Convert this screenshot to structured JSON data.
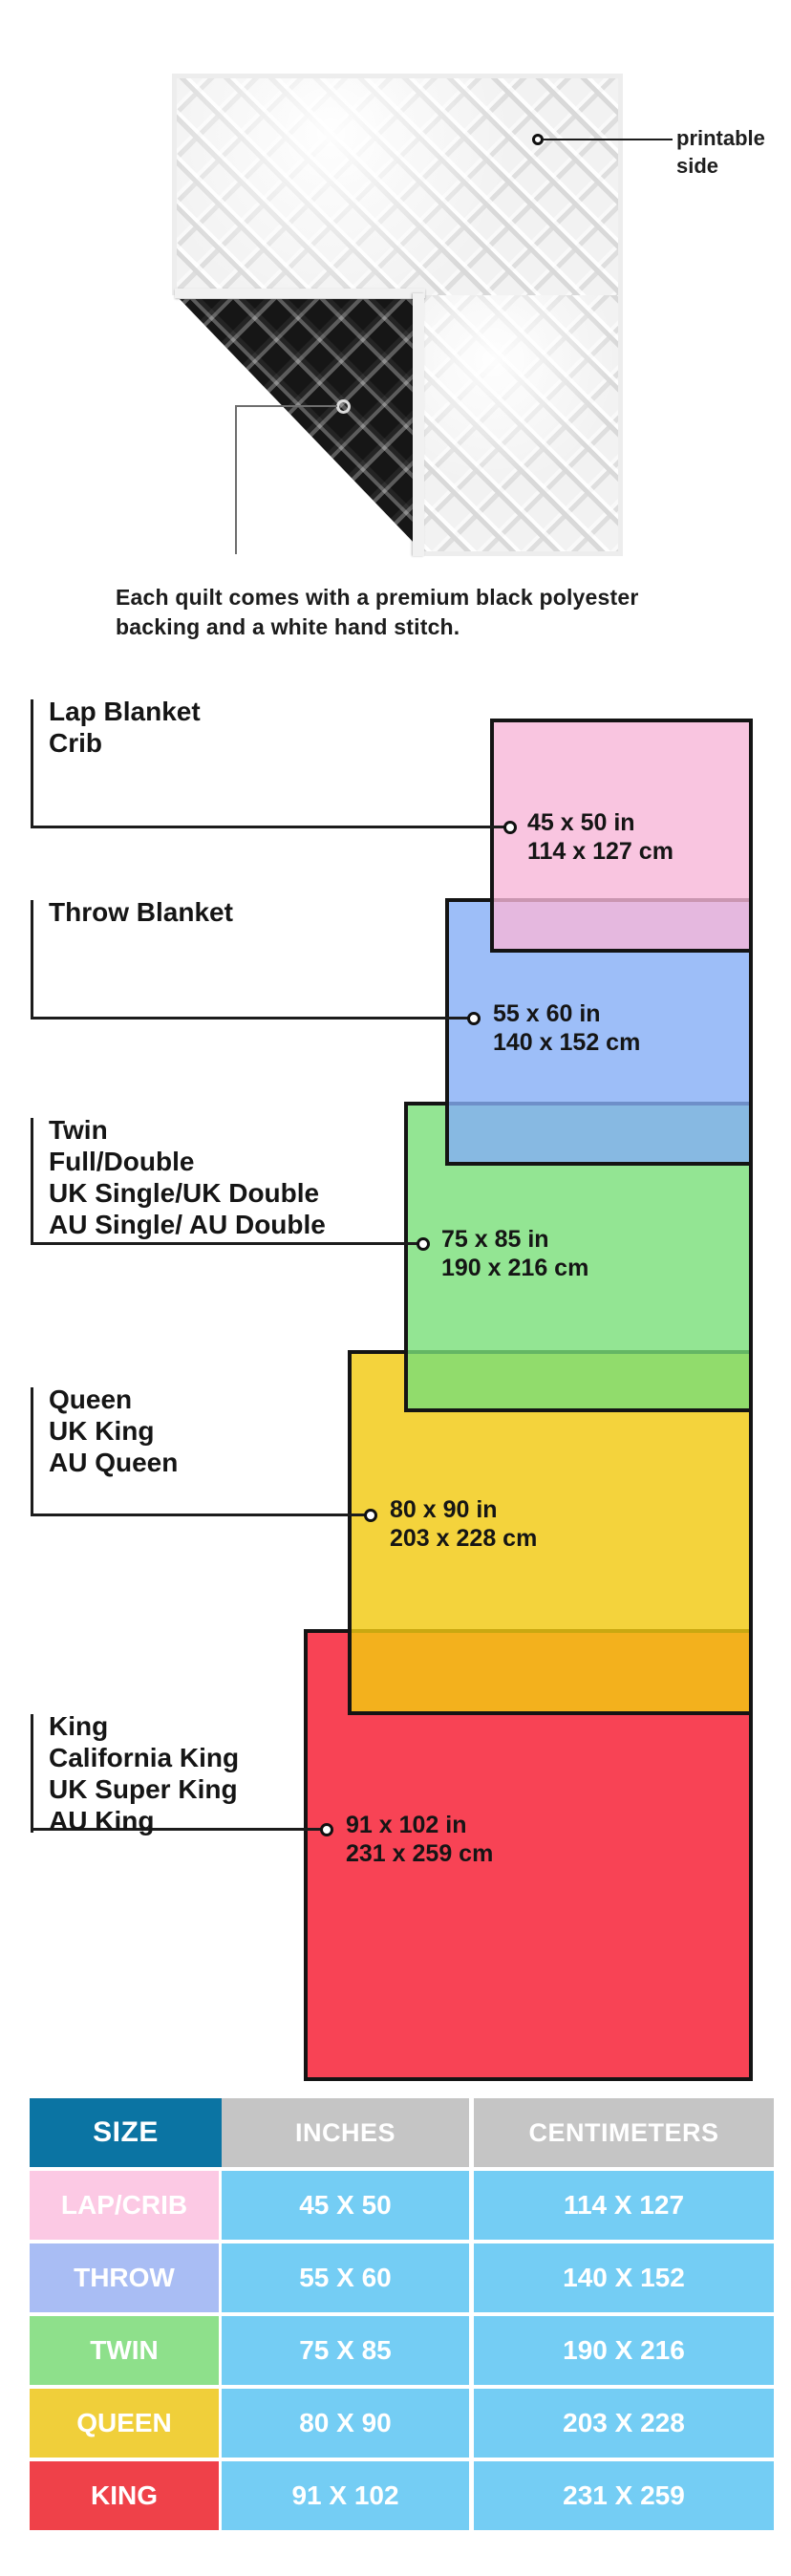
{
  "hero": {
    "printable_label": [
      "printable",
      "side"
    ],
    "caption": [
      "Each quilt comes with a premium black polyester",
      "backing and a white hand stitch."
    ]
  },
  "diagram": {
    "sizes": [
      {
        "id": "lap",
        "names": [
          "Lap Blanket",
          "Crib"
        ],
        "dim_in": "45 x 50 in",
        "dim_cm": "114 x 127 cm",
        "color": "#f9c7e1"
      },
      {
        "id": "throw",
        "names": [
          "Throw Blanket"
        ],
        "dim_in": "55 x 60 in",
        "dim_cm": "140 x 152 cm",
        "color": "#9dbef8"
      },
      {
        "id": "twin",
        "names": [
          "Twin",
          "Full/Double",
          "UK Single/UK Double",
          "AU Single/ AU Double"
        ],
        "dim_in": "75 x 85 in",
        "dim_cm": "190 x 216 cm",
        "color": "#93e593"
      },
      {
        "id": "queen",
        "names": [
          "Queen",
          "UK King",
          "AU Queen"
        ],
        "dim_in": "80 x 90 in",
        "dim_cm": "203 x 228 cm",
        "color": "#f4d33c"
      },
      {
        "id": "king",
        "names": [
          "King",
          "California King",
          "UK Super King",
          "AU King"
        ],
        "dim_in": "91 x 102 in",
        "dim_cm": "231 x 259 cm",
        "color": "#f84355"
      }
    ],
    "outline_color": "#141414"
  },
  "table": {
    "headers": [
      "SIZE",
      "INCHES",
      "CENTIMETERS"
    ],
    "rows": [
      {
        "size": "LAP/CRIB",
        "inches": "45 X 50",
        "cm": "114 X 127",
        "color": "#fcc9e4"
      },
      {
        "size": "THROW",
        "inches": "55 X 60",
        "cm": "140 X 152",
        "color": "#a9bdf4"
      },
      {
        "size": "TWIN",
        "inches": "75 X 85",
        "cm": "190 X 216",
        "color": "#8ee08b"
      },
      {
        "size": "QUEEN",
        "inches": "80 X 90",
        "cm": "203 X 228",
        "color": "#f0cf3a"
      },
      {
        "size": "KING",
        "inches": "91 X 102",
        "cm": "231 X 259",
        "color": "#ef4149"
      }
    ],
    "header_size_bg": "#0b74a3",
    "header_metric_bg": "#c5c5c5",
    "value_bg": "#74cdf4",
    "text_color": "#ffffff"
  }
}
